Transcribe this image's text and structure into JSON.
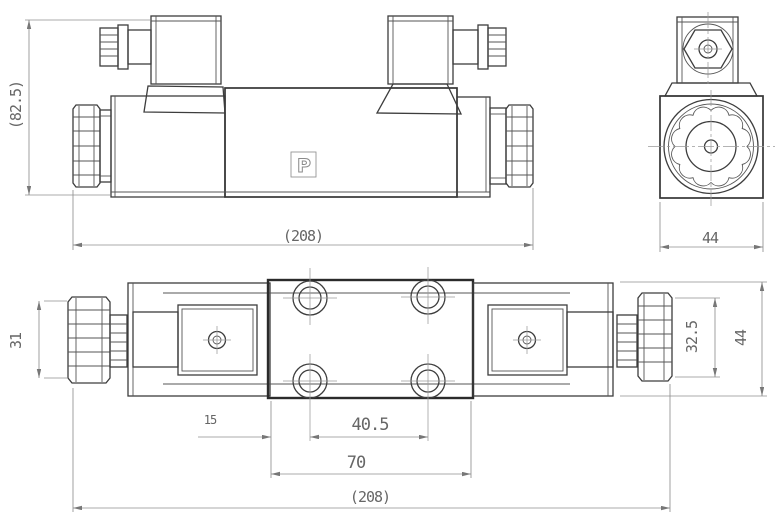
{
  "drawing": {
    "subject": "solenoid-directional-valve-dimensional-drawing",
    "logo_text": "P",
    "colors": {
      "background": "#ffffff",
      "outline": "#3d3d3d",
      "section_outline": "#2b2b2b",
      "dimension_lines": "#8f8f8f",
      "dimension_text": "#666666"
    },
    "dimensions": {
      "front_height": "(82.5)",
      "front_length": "(208)",
      "end_width": "44",
      "knob_left_od": "31",
      "knob_right_od": "32.5",
      "body_width": "44",
      "edge_to_hole": "15",
      "hole_spacing": "40.5",
      "block_length": "70",
      "top_length": "(208)"
    }
  }
}
